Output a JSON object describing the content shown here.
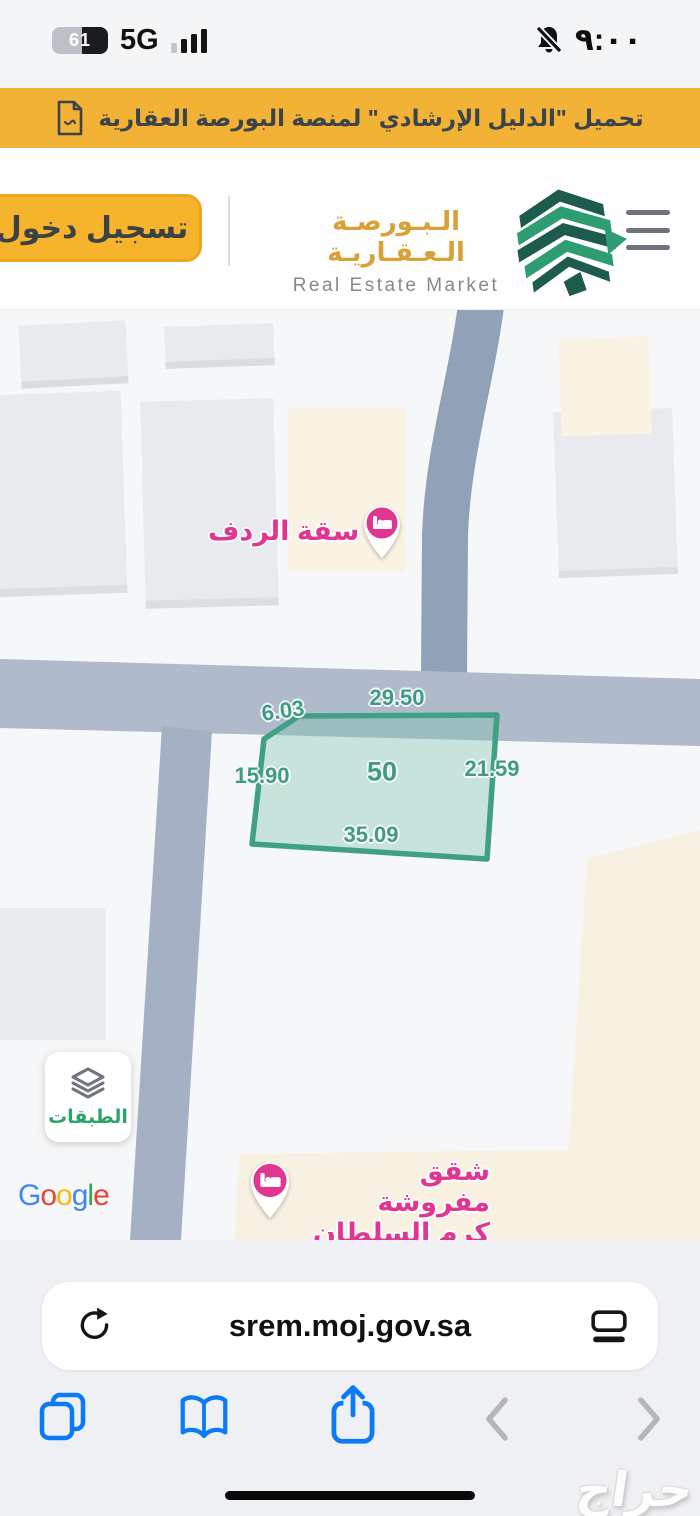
{
  "status_bar": {
    "battery_percent": "61",
    "network": "5G",
    "time": "٩:٠٠"
  },
  "banner": {
    "text": "تحميل \"الدليل الإرشادي\" لمنصة البورصة العقارية"
  },
  "header": {
    "login_label": "تسجيل دخول",
    "logo_ar": "الـبـورصـة الـعـقـاريـة",
    "logo_en": "Real Estate Market"
  },
  "map": {
    "parcel": {
      "number": "50",
      "side_top": "29.50",
      "side_top_left": "6.03",
      "side_left": "15.90",
      "side_right": "21.59",
      "side_bottom": "35.09"
    },
    "poi_hotel_1": {
      "label": "سقة الردف"
    },
    "poi_hotel_2": {
      "line1": "شقق مفروشة",
      "line2": "كرم السلطان"
    },
    "layers_button": {
      "label": "الطبقات"
    },
    "google_logo": {
      "l1": "G",
      "l2": "o",
      "l3": "o",
      "l4": "g",
      "l5": "l",
      "l6": "e"
    }
  },
  "browser": {
    "url": "srem.moj.gov.sa"
  },
  "watermark": {
    "text": "حراج"
  },
  "colors": {
    "banner_yellow": "#F2B235",
    "button_yellow": "#F6B42D",
    "logo_gold": "#D7A238",
    "logo_green_dark": "#1D5B4C",
    "logo_green": "#2E9E72",
    "parcel_stroke": "#3FA084",
    "parcel_fill": "#BFE0D4",
    "parcel_label_teal": "#3F9B85",
    "poi_pink": "#E0368F",
    "layers_green": "#2EA36B",
    "safari_blue": "#0A7AF6",
    "road_gray": "#A9B5C8",
    "beige_zone": "#FAF3E3"
  },
  "icons": {
    "pdf-icon": "document-outline",
    "battery-icon": "battery-with-percent",
    "cellular-signal-icon": "ascending-bars",
    "mute-bell-icon": "bell-with-slash",
    "menu-icon": "hamburger-3-lines",
    "bed-icon": "bed-in-pink-circle",
    "layers-icon": "stacked-diamonds",
    "reload-icon": "circular-arrow",
    "tab-layout-icon": "rectangle-over-line",
    "tabs-icon": "two-overlapping-squares",
    "bookmarks-icon": "open-book",
    "share-icon": "square-with-up-arrow",
    "back-icon": "chevron-left",
    "forward-icon": "chevron-right"
  }
}
